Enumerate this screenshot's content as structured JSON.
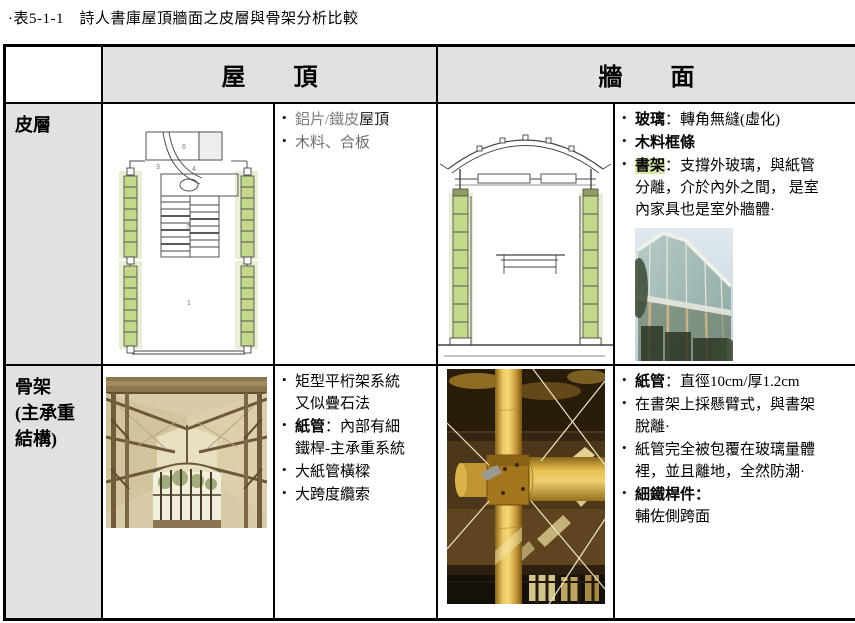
{
  "page": {
    "title": "·表5-1-1　詩人書庫屋頂牆面之皮層與骨架分析比較"
  },
  "ui": {
    "bullet": "•"
  },
  "header": {
    "roof": "屋　　頂",
    "wall": "牆　　面"
  },
  "rows": {
    "skin": {
      "label": "皮層",
      "roof": {
        "item1_head": "鋁片/鐵皮",
        "item1_tail": "屋頂",
        "item2": "木料、合板"
      },
      "wall": {
        "item1_head": "玻璃",
        "item1_tail": "：轉角無縫(虛化)",
        "item2": "木料框條",
        "item3_head": "書架",
        "item3_tail": "：支撐外玻璃，與紙管\n分離，介於內外之間， 是室\n內家具也是室外牆體·"
      }
    },
    "frame": {
      "label": "骨架\n(主承重\n結構)",
      "roof": {
        "item1": "矩型平桁架系統\n又似疊石法",
        "item2_head": "紙管",
        "item2_tail": "：內部有細\n鐵桿-主承重系統",
        "item3": "大紙管橫樑",
        "item4": "大跨度纜索"
      },
      "wall": {
        "item1_head": "紙管",
        "item1_tail": "：直徑10cm/厚1.2cm",
        "item2": "在書架上採懸臂式，與書架\n脫離·",
        "item3": "紙管完全被包覆在玻璃量體\n裡，並且離地，全然防潮·",
        "item4_head": "細鐵桿件：",
        "item4_tail": "\n輔佐側跨面"
      }
    }
  },
  "drawings": {
    "roof_plan": {
      "labels": [
        "6",
        "3",
        "4",
        "7",
        "1"
      ]
    }
  },
  "colors": {
    "table_header_bg": "#e1e1e1",
    "label_col_bg": "#e1e1e1",
    "shelf_green": "#c3d98a",
    "shelf_glow": "#e7f0d2",
    "highlight_green": "#d7e7ac",
    "paper_tube_yellow": "#e8c050",
    "border_black": "#000000"
  }
}
